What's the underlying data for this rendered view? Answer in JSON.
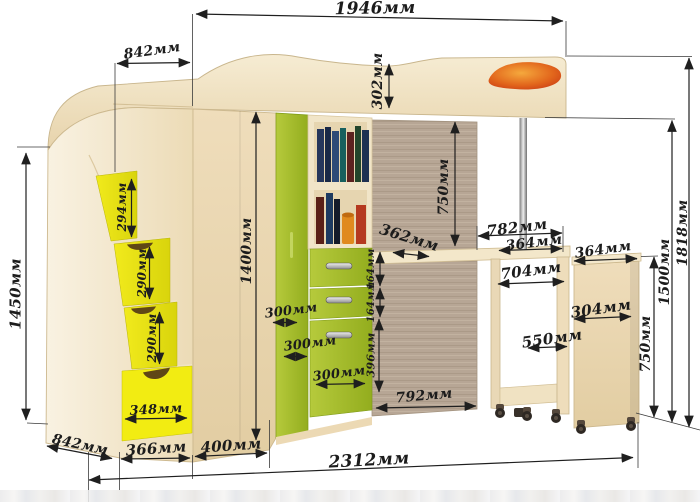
{
  "colors": {
    "wood_light": "#f0e2c4",
    "wood_dark_panel": "#b7a695",
    "accent_green": "#a5bd2b",
    "accent_yellow": "#ebe518",
    "accent_orange": "#e0701f",
    "dimension_ink": "#1f1f1f"
  },
  "dims": {
    "bed_length": "1946мм",
    "bed_depth": "842мм",
    "headboard_height": "302мм",
    "under_bed_clearance": "750мм",
    "desk_depth": "362мм",
    "desk_zone_width": "782мм",
    "desk_top_right_width": "364мм",
    "side_cabinet_width": "364мм",
    "desk_inner_width": "704мм",
    "side_cabinet_inner_width": "304мм",
    "desk_pullout_depth": "550мм",
    "side_cabinet_height": "750мм",
    "bed_platform_height": "1500мм",
    "total_height_right": "1818мм",
    "wardrobe_height": "1400мм",
    "drawer1_height": "164мм",
    "drawer2_height": "164мм",
    "drawer3_height": "396мм",
    "corner_face1_width": "300мм",
    "corner_face2_width": "300мм",
    "corner_face3_width": "300мм",
    "floor_gap_width": "792мм",
    "total_length": "2312мм",
    "stair_unit_height": "1450мм",
    "stair_unit_depth": "842мм",
    "stair_unit_width": "366мм",
    "corner_section_width": "400мм",
    "step1_height": "294мм",
    "step2_height": "290мм",
    "step3_height": "290мм",
    "stair_drawer_width": "348мм"
  }
}
